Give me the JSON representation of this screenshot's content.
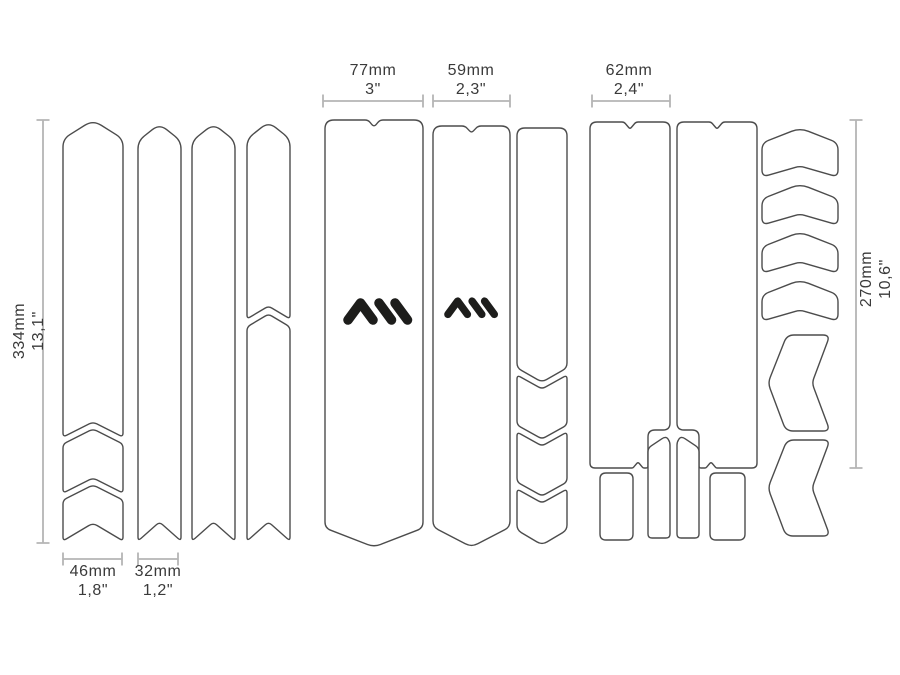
{
  "diagram": {
    "title": "Frame protection kit cutting template",
    "logo": {
      "name": "AMS",
      "description": "AMS mountain monogram"
    },
    "colors": {
      "background": "#ffffff",
      "outline": "#4c4c4c",
      "dimension_line": "#b5b5b5",
      "text": "#3a3a3a",
      "logo": "#1d1d1b"
    },
    "dimensions": {
      "left_column_height": {
        "mm": "334mm",
        "inch": "13,1\""
      },
      "strip_wide_width": {
        "mm": "46mm",
        "inch": "1,8\""
      },
      "strip_narrow_width": {
        "mm": "32mm",
        "inch": "1,2\""
      },
      "downtube_large_width": {
        "mm": "77mm",
        "inch": "3\""
      },
      "downtube_small_width": {
        "mm": "59mm",
        "inch": "2,3\""
      },
      "toptube_width": {
        "mm": "62mm",
        "inch": "2,4\""
      },
      "right_column_height": {
        "mm": "270mm",
        "inch": "10,6\""
      }
    }
  }
}
